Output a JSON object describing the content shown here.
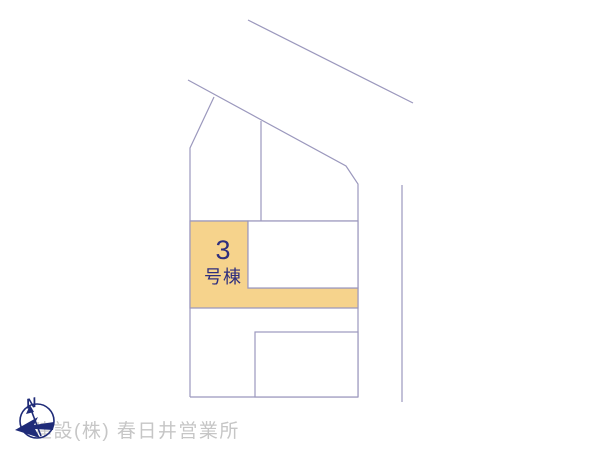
{
  "site_plan": {
    "highlighted_lot": {
      "number": "3",
      "suffix": "号棟"
    },
    "compass": {
      "north_label": "N"
    }
  },
  "footer": {
    "watermark": "建設(株) 春日井営業所"
  },
  "colors": {
    "highlight_fill": "#F6D38C",
    "line_color": "#9B98BD",
    "label_text": "#2E2E7E",
    "compass_ink": "#1F2B78",
    "watermark_text": "#C6C6C6"
  }
}
